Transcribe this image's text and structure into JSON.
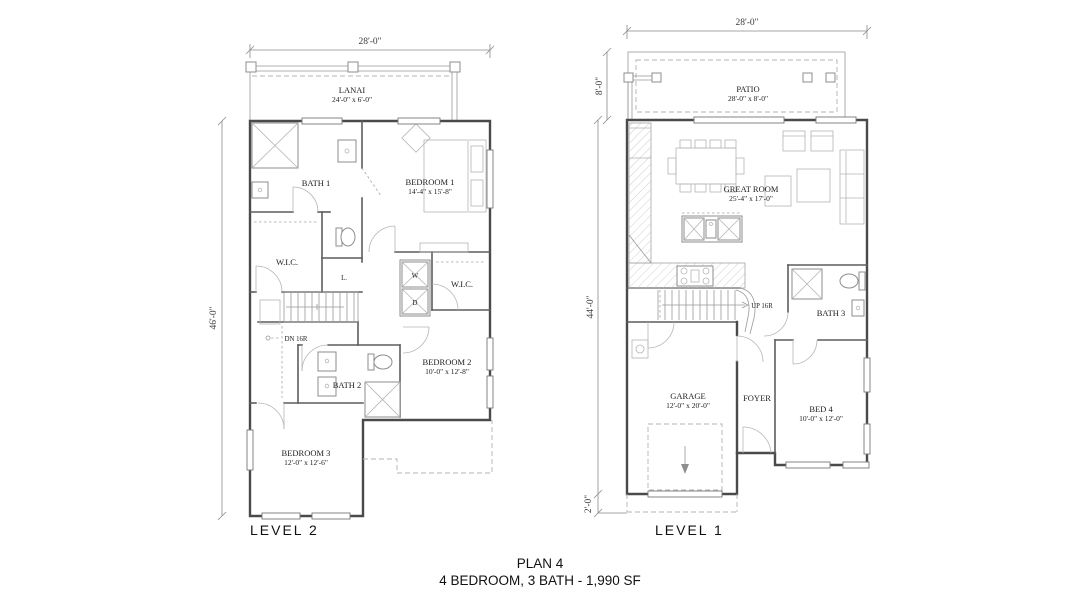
{
  "title": {
    "plan": "PLAN 4",
    "spec": "4 BEDROOM, 3 BATH - 1,990 SF"
  },
  "level2": {
    "label": "LEVEL 2",
    "dim_top": "28'-0\"",
    "dim_left": "46'-0\"",
    "rooms": {
      "lanai": {
        "name": "LANAI",
        "dims": "24'-0\" x 6'-0\""
      },
      "bath1": {
        "name": "BATH 1"
      },
      "bedroom1": {
        "name": "BEDROOM 1",
        "dims": "14'-4\" x 15'-8\""
      },
      "wic_left": {
        "name": "W.I.C."
      },
      "linen": {
        "name": "L."
      },
      "washer": {
        "name": "W"
      },
      "dryer": {
        "name": "D"
      },
      "wic_right": {
        "name": "W.I.C."
      },
      "stairs": {
        "name": "DN 16R"
      },
      "bath2": {
        "name": "BATH 2"
      },
      "bedroom2": {
        "name": "BEDROOM 2",
        "dims": "10'-0\" x 12'-8\""
      },
      "bedroom3": {
        "name": "BEDROOM 3",
        "dims": "12'-0\" x 12'-6\""
      }
    }
  },
  "level1": {
    "label": "LEVEL 1",
    "dim_top": "28'-0\"",
    "dim_patio": "8'-0\"",
    "dim_left": "44'-0\"",
    "dim_bottom": "2'-0\"",
    "rooms": {
      "patio": {
        "name": "PATIO",
        "dims": "28'-0\" x 8'-0\""
      },
      "great_room": {
        "name": "GREAT ROOM",
        "dims": "25'-4\" x 17'-0\""
      },
      "stairs": {
        "name": "UP 16R"
      },
      "bath3": {
        "name": "BATH 3"
      },
      "garage": {
        "name": "GARAGE",
        "dims": "12'-0\" x 20'-0\""
      },
      "foyer": {
        "name": "FOYER"
      },
      "bed4": {
        "name": "BED 4",
        "dims": "10'-0\" x 12'-0\""
      }
    }
  },
  "colors": {
    "background": "#ffffff",
    "wall": "#4a4a4a",
    "fixture": "#8e8e8e",
    "dashed": "#b3b3b3",
    "text": "#1c1c1c"
  }
}
